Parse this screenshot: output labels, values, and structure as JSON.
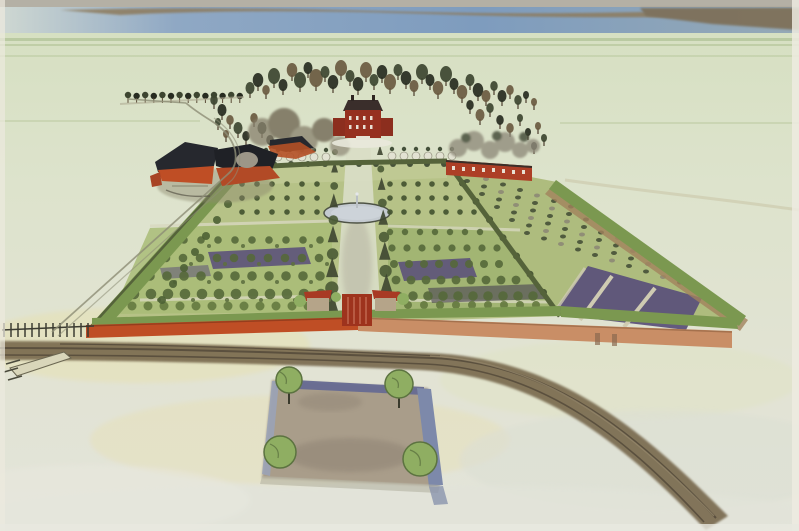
{
  "meta": {
    "kind": "watercolor-illustration",
    "subject": "Bird's-eye artist impression of a 17th-century walled formal garden estate",
    "view": "aerial perspective from the south, garden recedes toward a water horizon",
    "visible_text": "none"
  },
  "palette": {
    "paper": "#eceade",
    "field_light": "#d5dfc0",
    "field_mid": "#dde3cc",
    "field_low": "#e2e3d4",
    "field_yellow": "#e7dfaa",
    "top_strip": "#b4b0a5",
    "water_blue": "#7e9cbe",
    "shore_brown": "#8d7a5c",
    "horizon_green": "#a3b886",
    "tree_dark": "#3d4530",
    "tree_black": "#272b20",
    "tree_brown": "#6a5a40",
    "tree_grey": "#918c7c",
    "foliage": "#8fae62",
    "lawn": "#b3c083",
    "lawn_light": "#a9bc77",
    "hedge": "#7b9850",
    "hedge_dark": "#55633a",
    "wall_red": "#bf4e25",
    "wall_salmon": "#c98e66",
    "brick_red": "#a83a24",
    "roof_dark": "#26282e",
    "mansion_red": "#96301f",
    "purple_bed": "#5c527a",
    "path_pale": "#dcdcc6",
    "avenue": "#d9ddc6",
    "smoke": "#b0ab9c",
    "road_brown": "#746549",
    "road_dark": "#4e4436",
    "road_light": "#998a6e",
    "moat_dark": "#666a92",
    "moat_mid": "#7d89aa",
    "moat_light": "#9aa3b8",
    "court_ground": "#a99d8a",
    "court_shadow": "#8d8172",
    "basin_grey": "#c4cad0",
    "basin_rim": "#4e5345",
    "track_line": "#8e8e76",
    "fence_dark": "#3c3c32",
    "haystack_grey": "#9c9688"
  },
  "scene": {
    "horizon": [
      "grey paper strip",
      "blue water band",
      "brown far shore dike"
    ],
    "background": [
      "pale green open fields",
      "receding tree row to the left",
      "dark tree belt behind the house"
    ],
    "estate": [
      "red-brick mansion with dark roof on central axis",
      "farm complex with black roofs and red-orange walls (left)",
      "red orangery wall building (right of house)",
      "central avenue with fountain basin and jet",
      "parterres and orchard plots with rows of small trees",
      "purple planted beds",
      "kitchen-garden compartment with purple basins (right)",
      "red-orange perimeter wall with green hedge",
      "central gate flanked by two red-roofed lodges"
    ],
    "foreground": [
      "dark brown country road curving to lower right",
      "rectangular forecourt enclosed by blue moat",
      "four round trees at forecourt corners",
      "wooden fence and sluice at far left"
    ]
  }
}
